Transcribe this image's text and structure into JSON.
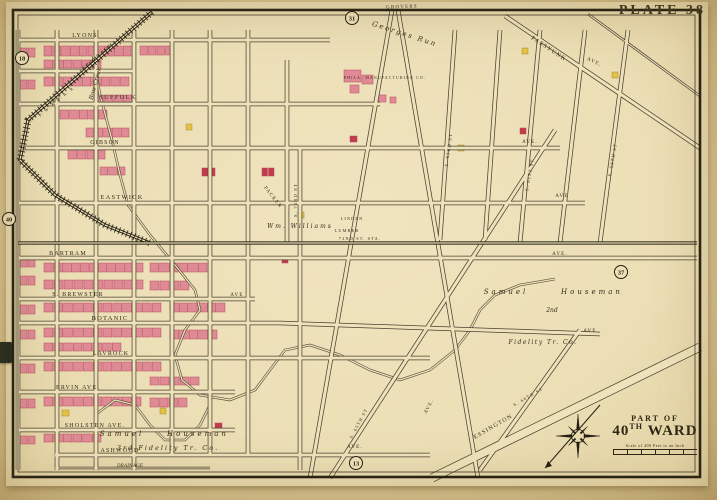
{
  "plate": {
    "label": "PLATE 38"
  },
  "title_block": {
    "part_of": "PART OF",
    "ward_number": "40",
    "ward_sup": "TH",
    "ward_word": "WARD",
    "scale_text": "Scale of 400 Feet to an Inch"
  },
  "colors": {
    "paper": "#eee2ba",
    "line": "#4a4130",
    "dark": "#241f12",
    "text": "#342c1a",
    "brick": "#e08a96",
    "brick_stroke": "#b44a5e",
    "red": "#c23b4a",
    "frame_yellow": "#e2c247",
    "frame_stroke": "#a88d2a"
  },
  "plate_refs": [
    {
      "n": "18",
      "x": 22,
      "y": 58
    },
    {
      "n": "40",
      "x": 9,
      "y": 219
    },
    {
      "n": "31",
      "x": 352,
      "y": 18
    },
    {
      "n": "37",
      "x": 621,
      "y": 272
    },
    {
      "n": "13",
      "x": 356,
      "y": 463
    }
  ],
  "border": {
    "outer": [
      13,
      10,
      687,
      467
    ],
    "inner": [
      18,
      15,
      677,
      457
    ]
  },
  "roads": [
    {
      "pts": [
        [
          18,
          40
        ],
        [
          330,
          40
        ]
      ]
    },
    {
      "pts": [
        [
          18,
          71
        ],
        [
          134,
          71
        ]
      ]
    },
    {
      "pts": [
        [
          18,
          104
        ],
        [
          380,
          104
        ]
      ]
    },
    {
      "pts": [
        [
          18,
          148
        ],
        [
          560,
          148
        ]
      ]
    },
    {
      "pts": [
        [
          18,
          203
        ],
        [
          585,
          203
        ]
      ]
    },
    {
      "pts": [
        [
          18,
          258
        ],
        [
          697,
          258
        ]
      ]
    },
    {
      "pts": [
        [
          18,
          299
        ],
        [
          255,
          299
        ]
      ]
    },
    {
      "pts": [
        [
          18,
          323
        ],
        [
          280,
          323
        ],
        [
          600,
          334
        ]
      ]
    },
    {
      "pts": [
        [
          18,
          358
        ],
        [
          430,
          358
        ]
      ]
    },
    {
      "pts": [
        [
          18,
          392
        ],
        [
          235,
          392
        ]
      ]
    },
    {
      "pts": [
        [
          18,
          430
        ],
        [
          235,
          430
        ]
      ]
    },
    {
      "pts": [
        [
          55,
          455
        ],
        [
          430,
          455
        ]
      ]
    },
    {
      "pts": [
        [
          55,
          468
        ],
        [
          210,
          468
        ]
      ],
      "w": 2.4
    },
    {
      "pts": [
        [
          18,
          30
        ],
        [
          18,
          470
        ]
      ]
    },
    {
      "pts": [
        [
          57,
          30
        ],
        [
          57,
          470
        ]
      ]
    },
    {
      "pts": [
        [
          96,
          30
        ],
        [
          96,
          470
        ]
      ]
    },
    {
      "pts": [
        [
          134,
          30
        ],
        [
          134,
          470
        ]
      ]
    },
    {
      "pts": [
        [
          172,
          30
        ],
        [
          172,
          455
        ]
      ]
    },
    {
      "pts": [
        [
          210,
          30
        ],
        [
          210,
          455
        ]
      ]
    },
    {
      "pts": [
        [
          248,
          30
        ],
        [
          248,
          455
        ]
      ]
    },
    {
      "pts": [
        [
          287,
          60
        ],
        [
          287,
          243
        ]
      ]
    },
    {
      "pts": [
        [
          300,
          148
        ],
        [
          300,
          470
        ]
      ]
    },
    {
      "pts": [
        [
          455,
          30
        ],
        [
          440,
          240
        ]
      ]
    },
    {
      "pts": [
        [
          500,
          30
        ],
        [
          485,
          240
        ]
      ]
    },
    {
      "pts": [
        [
          540,
          30
        ],
        [
          520,
          243
        ]
      ]
    },
    {
      "pts": [
        [
          585,
          30
        ],
        [
          560,
          243
        ]
      ]
    },
    {
      "pts": [
        [
          628,
          30
        ],
        [
          600,
          243
        ]
      ]
    },
    {
      "pts": [
        [
          505,
          16
        ],
        [
          700,
          148
        ]
      ]
    },
    {
      "pts": [
        [
          588,
          14
        ],
        [
          700,
          96
        ]
      ],
      "w": 2.6
    },
    {
      "pts": [
        [
          392,
          10
        ],
        [
          310,
          478
        ]
      ]
    },
    {
      "pts": [
        [
          398,
          10
        ],
        [
          478,
          478
        ]
      ]
    },
    {
      "pts": [
        [
          555,
          130
        ],
        [
          330,
          478
        ]
      ]
    },
    {
      "pts": [
        [
          580,
          330
        ],
        [
          480,
          470
        ]
      ]
    },
    {
      "pts": [
        [
          700,
          347
        ],
        [
          432,
          478
        ]
      ],
      "w": 9
    }
  ],
  "rails": [
    {
      "pts": [
        [
          152,
          12
        ],
        [
          60,
          92
        ],
        [
          28,
          120
        ],
        [
          20,
          160
        ],
        [
          55,
          195
        ],
        [
          105,
          225
        ],
        [
          150,
          243
        ]
      ],
      "hatch": true
    },
    {
      "pts": [
        [
          18,
          243
        ],
        [
          697,
          243
        ]
      ],
      "hatch": false
    }
  ],
  "creeks": [
    {
      "pts": [
        [
          93,
          55
        ],
        [
          100,
          95
        ],
        [
          112,
          140
        ],
        [
          120,
          175
        ],
        [
          128,
          205
        ],
        [
          150,
          235
        ],
        [
          175,
          265
        ],
        [
          195,
          290
        ],
        [
          200,
          310
        ],
        [
          185,
          330
        ],
        [
          175,
          355
        ],
        [
          182,
          380
        ],
        [
          200,
          395
        ],
        [
          230,
          400
        ],
        [
          255,
          390
        ],
        [
          270,
          370
        ],
        [
          285,
          350
        ],
        [
          310,
          345
        ],
        [
          340,
          355
        ],
        [
          370,
          370
        ],
        [
          400,
          380
        ],
        [
          430,
          370
        ],
        [
          455,
          350
        ],
        [
          470,
          330
        ],
        [
          480,
          310
        ],
        [
          495,
          295
        ],
        [
          520,
          285
        ],
        [
          555,
          279
        ]
      ]
    },
    {
      "pts": [
        [
          95,
          415
        ],
        [
          115,
          400
        ],
        [
          135,
          405
        ],
        [
          150,
          425
        ],
        [
          165,
          440
        ],
        [
          185,
          440
        ],
        [
          200,
          425
        ],
        [
          210,
          405
        ]
      ]
    }
  ],
  "labels": [
    {
      "t": "LYONS",
      "x": 85,
      "y": 37,
      "s": 6,
      "st": "cap"
    },
    {
      "t": "SUFFOLK",
      "x": 118,
      "y": 99,
      "s": 6.5,
      "st": "cap"
    },
    {
      "t": "GIBSON",
      "x": 105,
      "y": 144,
      "s": 6,
      "st": "cap"
    },
    {
      "t": "AVE.",
      "x": 530,
      "y": 143,
      "s": 5,
      "st": "cap"
    },
    {
      "t": "EASTWICK",
      "x": 122,
      "y": 199,
      "s": 6.5,
      "st": "cap"
    },
    {
      "t": "AVE",
      "x": 562,
      "y": 197,
      "s": 5,
      "st": "cap"
    },
    {
      "t": "BARTRAM",
      "x": 68,
      "y": 255,
      "s": 6,
      "st": "cap"
    },
    {
      "t": "AVE.",
      "x": 560,
      "y": 255,
      "s": 5,
      "st": "cap"
    },
    {
      "t": "S. BREWSTER",
      "x": 78,
      "y": 296,
      "s": 6,
      "st": "cap"
    },
    {
      "t": "AVE",
      "x": 237,
      "y": 296,
      "s": 5,
      "st": "cap"
    },
    {
      "t": "BOTANIC",
      "x": 110,
      "y": 320,
      "s": 6.5,
      "st": "cap"
    },
    {
      "t": "AVE",
      "x": 590,
      "y": 332,
      "s": 5,
      "st": "cap"
    },
    {
      "t": "LAVROCK",
      "x": 111,
      "y": 355,
      "s": 6,
      "st": "cap"
    },
    {
      "t": "ERVIN  AVE.",
      "x": 78,
      "y": 389,
      "s": 6,
      "st": "cap"
    },
    {
      "t": "SHOLSTEN  AVE.",
      "x": 95,
      "y": 427,
      "s": 6,
      "st": "cap"
    },
    {
      "t": "ASHWOOD",
      "x": 120,
      "y": 452,
      "s": 6,
      "st": "cap"
    },
    {
      "t": "DRAINAGE",
      "x": 130,
      "y": 467,
      "s": 4.5,
      "st": "it"
    },
    {
      "t": "GROVERS",
      "x": 402,
      "y": 8,
      "s": 5,
      "st": "cap",
      "r": -2
    },
    {
      "t": "PASSYUNK",
      "x": 548,
      "y": 50,
      "s": 6,
      "st": "cap",
      "r": 33
    },
    {
      "t": "AVE.",
      "x": 594,
      "y": 63,
      "s": 5,
      "st": "cap",
      "r": 25
    },
    {
      "t": "S. 61ST ST",
      "x": 531,
      "y": 175,
      "s": 4.5,
      "st": "cap",
      "r": -80
    },
    {
      "t": "S. 63RD ST",
      "x": 450,
      "y": 150,
      "s": 4.5,
      "st": "cap",
      "r": -82
    },
    {
      "t": "S. 58TH ST",
      "x": 614,
      "y": 160,
      "s": 4.5,
      "st": "cap",
      "r": -80
    },
    {
      "t": "S. 73RD ST",
      "x": 297,
      "y": 200,
      "s": 4.5,
      "st": "cap",
      "r": -90
    },
    {
      "t": "PACKER",
      "x": 272,
      "y": 198,
      "s": 5,
      "st": "cap",
      "r": 52
    },
    {
      "t": "ESSINGTON",
      "x": 494,
      "y": 428,
      "s": 6,
      "st": "cap",
      "r": -30
    },
    {
      "t": "S. 66TH ST",
      "x": 529,
      "y": 398,
      "s": 4.5,
      "st": "cap",
      "r": -30
    },
    {
      "t": "S. 65TH ST",
      "x": 360,
      "y": 424,
      "s": 4.5,
      "st": "cap",
      "r": -62
    },
    {
      "t": "AVE.",
      "x": 355,
      "y": 448,
      "s": 5,
      "st": "cap"
    },
    {
      "t": "AVE.",
      "x": 430,
      "y": 407,
      "s": 5,
      "st": "cap",
      "r": -62
    },
    {
      "t": "GRAYS  AVE.",
      "x": 99,
      "y": 57,
      "s": 5,
      "st": "cap",
      "r": -40
    },
    {
      "t": "P. W. & B. R. R.",
      "x": 58,
      "y": 102,
      "s": 4.2,
      "st": "cap",
      "r": -40
    },
    {
      "t": "LINDEN",
      "x": 352,
      "y": 220,
      "s": 4.2,
      "st": "cap"
    },
    {
      "t": "LUMBER",
      "x": 347,
      "y": 232,
      "s": 4.2,
      "st": "cap"
    },
    {
      "t": "72ND ST. STA.",
      "x": 360,
      "y": 240,
      "s": 4.2,
      "st": "cap"
    },
    {
      "t": "Wm. Williams",
      "x": 300,
      "y": 228,
      "s": 6,
      "st": "it",
      "ls": 2
    },
    {
      "t": "PHILA. MANUFACTURING CO.",
      "x": 385,
      "y": 79,
      "s": 3.8,
      "st": "cap"
    },
    {
      "t": "Samuel",
      "x": 506,
      "y": 294,
      "s": 7,
      "st": "it",
      "ls": 3
    },
    {
      "t": "Houseman",
      "x": 592,
      "y": 294,
      "s": 7,
      "st": "it",
      "ls": 3
    },
    {
      "t": "2nd",
      "x": 552,
      "y": 312,
      "s": 6,
      "st": "it"
    },
    {
      "t": "Fidelity Tr. Co.",
      "x": 543,
      "y": 344,
      "s": 6,
      "st": "it",
      "ls": 1.5
    },
    {
      "t": "Samuel",
      "x": 122,
      "y": 436,
      "s": 7,
      "st": "it",
      "ls": 3
    },
    {
      "t": "Houseman",
      "x": 198,
      "y": 436,
      "s": 7,
      "st": "it",
      "ls": 3
    },
    {
      "t": "3rd Fidelity Tr. Co.",
      "x": 168,
      "y": 450,
      "s": 6.5,
      "st": "it",
      "ls": 2
    },
    {
      "t": "Georges Run",
      "x": 404,
      "y": 36,
      "s": 7,
      "st": "it",
      "ls": 2,
      "r": 18
    },
    {
      "t": "Bow Creek",
      "x": 97,
      "y": 84,
      "s": 6,
      "st": "it",
      "r": -75
    }
  ],
  "buildings": [
    {
      "x": 44,
      "y": 46,
      "w": 88,
      "h": 10,
      "n": 10,
      "c": "brick"
    },
    {
      "x": 44,
      "y": 60,
      "w": 58,
      "h": 8,
      "n": 6,
      "c": "brick"
    },
    {
      "x": 140,
      "y": 46,
      "w": 34,
      "h": 9,
      "n": 4,
      "c": "brick"
    },
    {
      "x": 44,
      "y": 77,
      "w": 86,
      "h": 9,
      "n": 9,
      "c": "brick"
    },
    {
      "x": 95,
      "y": 95,
      "w": 38,
      "h": 9,
      "n": 4,
      "c": "brick"
    },
    {
      "x": 60,
      "y": 110,
      "w": 48,
      "h": 9,
      "n": 5,
      "c": "brick"
    },
    {
      "x": 86,
      "y": 128,
      "w": 44,
      "h": 9,
      "n": 5,
      "c": "brick"
    },
    {
      "x": 68,
      "y": 150,
      "w": 38,
      "h": 9,
      "n": 4,
      "c": "brick"
    },
    {
      "x": 100,
      "y": 167,
      "w": 26,
      "h": 8,
      "n": 3,
      "c": "brick"
    },
    {
      "x": 344,
      "y": 70,
      "w": 18,
      "h": 12,
      "n": 1,
      "c": "brick"
    },
    {
      "x": 362,
      "y": 75,
      "w": 12,
      "h": 9,
      "n": 1,
      "c": "brick"
    },
    {
      "x": 350,
      "y": 85,
      "w": 10,
      "h": 8,
      "n": 1,
      "c": "brick"
    },
    {
      "x": 378,
      "y": 95,
      "w": 9,
      "h": 7,
      "n": 1,
      "c": "brick"
    },
    {
      "x": 390,
      "y": 97,
      "w": 7,
      "h": 6,
      "n": 1,
      "c": "brick"
    },
    {
      "x": 202,
      "y": 168,
      "w": 14,
      "h": 8,
      "n": 2,
      "c": "red"
    },
    {
      "x": 262,
      "y": 168,
      "w": 13,
      "h": 8,
      "n": 2,
      "c": "red"
    },
    {
      "x": 350,
      "y": 136,
      "w": 8,
      "h": 6,
      "n": 1,
      "c": "red"
    },
    {
      "x": 282,
      "y": 257,
      "w": 7,
      "h": 6,
      "n": 1,
      "c": "red"
    },
    {
      "x": 520,
      "y": 128,
      "w": 7,
      "h": 6,
      "n": 1,
      "c": "red"
    },
    {
      "x": 215,
      "y": 423,
      "w": 8,
      "h": 7,
      "n": 1,
      "c": "red"
    },
    {
      "x": 186,
      "y": 124,
      "w": 7,
      "h": 6,
      "n": 1,
      "c": "frame_yellow"
    },
    {
      "x": 298,
      "y": 212,
      "w": 7,
      "h": 6,
      "n": 1,
      "c": "frame_yellow"
    },
    {
      "x": 458,
      "y": 145,
      "w": 7,
      "h": 6,
      "n": 1,
      "c": "frame_yellow"
    },
    {
      "x": 522,
      "y": 48,
      "w": 7,
      "h": 6,
      "n": 1,
      "c": "frame_yellow"
    },
    {
      "x": 612,
      "y": 72,
      "w": 7,
      "h": 6,
      "n": 1,
      "c": "frame_yellow"
    },
    {
      "x": 62,
      "y": 410,
      "w": 8,
      "h": 6,
      "n": 1,
      "c": "frame_yellow"
    },
    {
      "x": 160,
      "y": 408,
      "w": 7,
      "h": 6,
      "n": 1,
      "c": "frame_yellow"
    },
    {
      "x": 44,
      "y": 263,
      "w": 100,
      "h": 9,
      "n": 11,
      "c": "brick"
    },
    {
      "x": 44,
      "y": 280,
      "w": 100,
      "h": 9,
      "n": 10,
      "c": "brick"
    },
    {
      "x": 150,
      "y": 263,
      "w": 58,
      "h": 9,
      "n": 6,
      "c": "brick"
    },
    {
      "x": 150,
      "y": 281,
      "w": 40,
      "h": 9,
      "n": 4,
      "c": "brick"
    },
    {
      "x": 44,
      "y": 303,
      "w": 118,
      "h": 9,
      "n": 12,
      "c": "brick"
    },
    {
      "x": 170,
      "y": 303,
      "w": 56,
      "h": 9,
      "n": 6,
      "c": "brick"
    },
    {
      "x": 44,
      "y": 328,
      "w": 118,
      "h": 9,
      "n": 12,
      "c": "brick"
    },
    {
      "x": 44,
      "y": 343,
      "w": 78,
      "h": 8,
      "n": 8,
      "c": "brick"
    },
    {
      "x": 170,
      "y": 330,
      "w": 48,
      "h": 9,
      "n": 5,
      "c": "brick"
    },
    {
      "x": 44,
      "y": 362,
      "w": 118,
      "h": 9,
      "n": 12,
      "c": "brick"
    },
    {
      "x": 150,
      "y": 377,
      "w": 50,
      "h": 8,
      "n": 5,
      "c": "brick"
    },
    {
      "x": 44,
      "y": 397,
      "w": 98,
      "h": 9,
      "n": 10,
      "c": "brick"
    },
    {
      "x": 150,
      "y": 398,
      "w": 38,
      "h": 9,
      "n": 4,
      "c": "brick"
    },
    {
      "x": 44,
      "y": 434,
      "w": 58,
      "h": 8,
      "n": 6,
      "c": "brick"
    },
    {
      "x": 20,
      "y": 48,
      "w": 16,
      "h": 9,
      "n": 2,
      "c": "brick"
    },
    {
      "x": 20,
      "y": 80,
      "w": 16,
      "h": 9,
      "n": 2,
      "c": "brick"
    },
    {
      "x": 20,
      "y": 258,
      "w": 16,
      "h": 9,
      "n": 2,
      "c": "brick"
    },
    {
      "x": 20,
      "y": 276,
      "w": 16,
      "h": 9,
      "n": 2,
      "c": "brick"
    },
    {
      "x": 20,
      "y": 305,
      "w": 16,
      "h": 9,
      "n": 2,
      "c": "brick"
    },
    {
      "x": 20,
      "y": 330,
      "w": 16,
      "h": 9,
      "n": 2,
      "c": "brick"
    },
    {
      "x": 20,
      "y": 364,
      "w": 16,
      "h": 9,
      "n": 2,
      "c": "brick"
    },
    {
      "x": 20,
      "y": 399,
      "w": 16,
      "h": 9,
      "n": 2,
      "c": "brick"
    },
    {
      "x": 20,
      "y": 436,
      "w": 16,
      "h": 8,
      "n": 2,
      "c": "brick"
    }
  ],
  "compass": {
    "cx": 578,
    "cy": 436,
    "r": 22,
    "needle": [
      [
        600,
        405
      ],
      [
        545,
        468
      ]
    ]
  }
}
